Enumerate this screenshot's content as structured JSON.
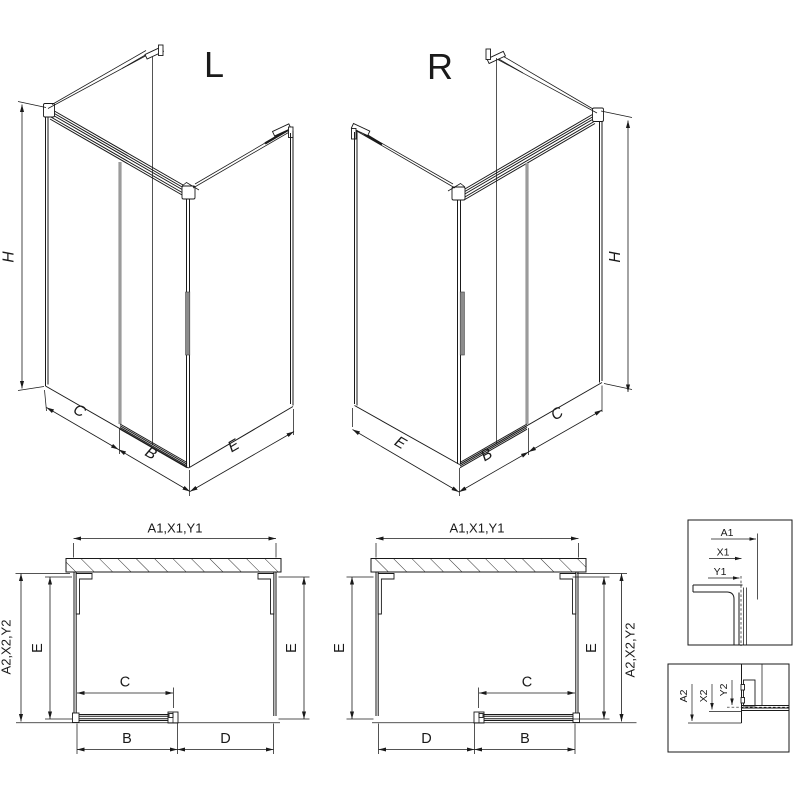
{
  "drawing": {
    "type": "technical-line-drawing",
    "subject": "corner shower enclosure with sliding door, left (L) and right (R) variants, isometric views, plan views and profile detail callouts",
    "colors": {
      "line": "#1a1a1a",
      "door_edge": "#9b9b9b",
      "handle_fill": "#8c8c8c",
      "background": "#ffffff"
    }
  },
  "labels": {
    "iso_left": {
      "title": "L",
      "h": "H",
      "c": "C",
      "b": "B",
      "e": "E"
    },
    "iso_right": {
      "title": "R",
      "h": "H",
      "e": "E",
      "b": "B",
      "c": "C"
    },
    "plan_left": {
      "width": "A1,X1,Y1",
      "depth": "A2,X2,Y2",
      "e_left": "E",
      "e_right": "E",
      "c": "C",
      "b": "B",
      "d": "D"
    },
    "plan_right": {
      "width": "A1,X1,Y1",
      "depth": "A2,X2,Y2",
      "e_left": "E",
      "e_right": "E",
      "c": "C",
      "d": "D",
      "b": "B"
    },
    "detail_top": {
      "a1": "A1",
      "x1": "X1",
      "y1": "Y1"
    },
    "detail_bottom": {
      "a2": "A2",
      "x2": "X2",
      "y2": "Y2"
    }
  }
}
